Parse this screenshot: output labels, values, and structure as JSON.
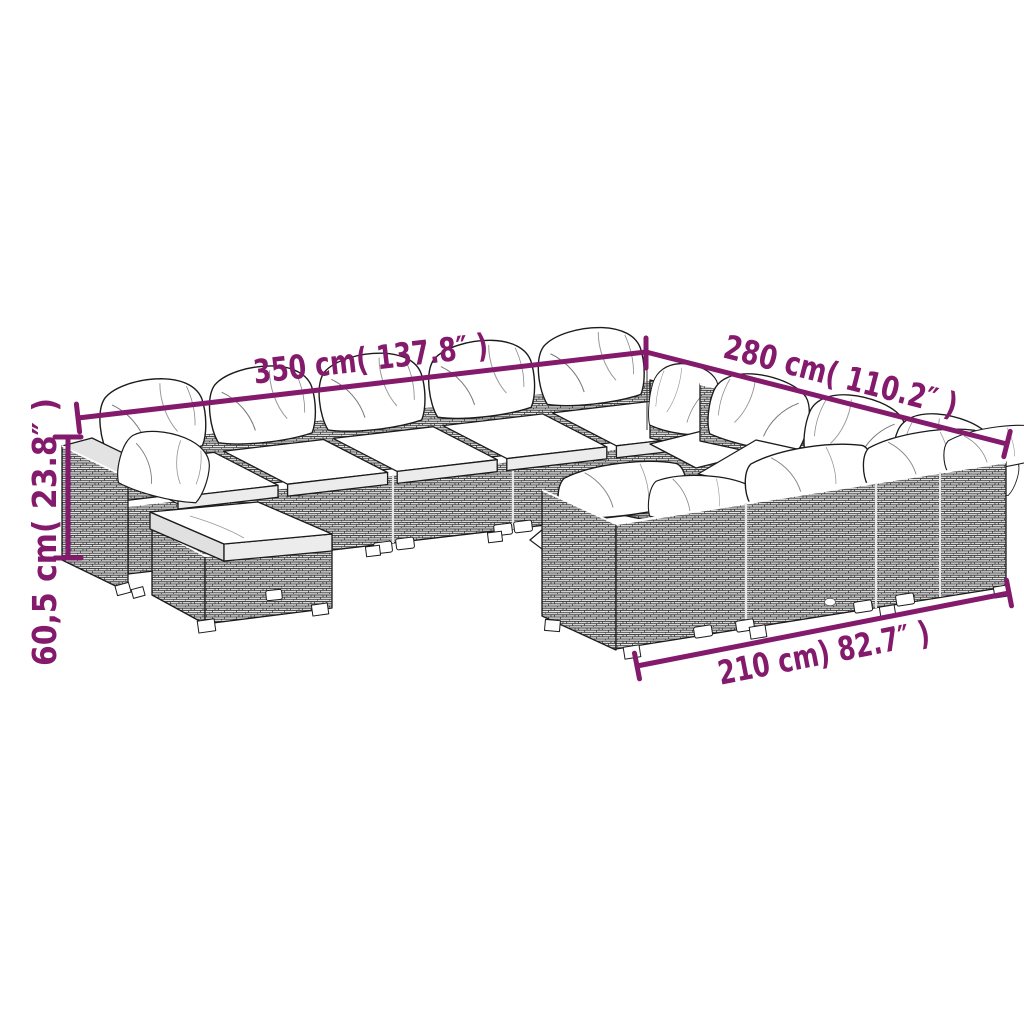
{
  "page": {
    "background": "#ffffff"
  },
  "colors": {
    "accent": "#841A6B",
    "line_art": "#1b1b1b",
    "cushion": "#ffffff"
  },
  "diagram": {
    "subject": "rattan-garden-lounge-set-line-drawing",
    "labels": {
      "top_left": "350 cm( 137.8″ )",
      "top_right": "280 cm( 110.2″ )",
      "left": "60,5 cm( 23.8″ )",
      "bottom_right": "210 cm) 82.7″ )"
    }
  }
}
